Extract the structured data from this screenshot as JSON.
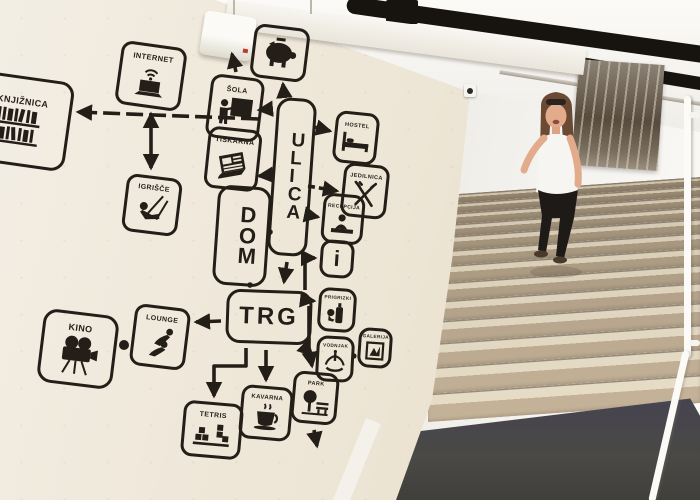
{
  "scene": {
    "setting": "hostel stairwell with black stencil mind-map mural painted on a cream wall; a woman walks down beige stone stairs; black pipes cross the white ceiling; a black-and-white forest photograph hangs on the upper wall; dark grey mat at the foot of the stairs; white handrail on the right wall",
    "colors": {
      "mural_wall": "#ece4d5",
      "stencil_ink": "#241e18",
      "back_wall": "#f4f2ee",
      "step_tread": "#ddd2bb",
      "step_riser": "#a69778",
      "floor_mat": "#4a4945",
      "pipes": "#17130f",
      "handrail": "#fcfbf8"
    },
    "objects": [
      "ceiling-pipes",
      "wall-beam",
      "light-fixture",
      "security-camera",
      "framed-forest-photo",
      "staircase",
      "floor-mat",
      "handrail",
      "woman-descending-stairs"
    ]
  },
  "mural": {
    "labels": {
      "knjiznica": "KNJIŽNICA",
      "internet": "INTERNET",
      "sola": "ŠOLA",
      "tiskarna": "TISKARNA",
      "ulica": "ULICA",
      "dom": "DOM",
      "igrisce": "IGRIŠČE",
      "hostel": "HOSTEL",
      "jedilnica": "JEDILNICA",
      "recepcija": "RECEPCIJA",
      "info": "i",
      "prigrizki": "PRIGRIZKI",
      "vodnjak": "VODNJAK",
      "galerija": "GALERIJA",
      "trg": "TRG",
      "kino": "KINO",
      "lounge": "LOUNGE",
      "tetris": "TETRIS",
      "kavarna": "KAVARNA",
      "park": "PARK"
    },
    "icons": [
      "bookshelf-icon",
      "laptop-wifi-icon",
      "piggy-bank-icon",
      "teacher-blackboard-icon",
      "newspaper-icon",
      "swing-icon",
      "bed-icon",
      "fork-knife-icon",
      "reception-desk-icon",
      "info-icon",
      "snack-drink-icon",
      "fountain-icon",
      "picture-frame-icon",
      "movie-camera-icon",
      "lounge-person-icon",
      "tetris-blocks-icon",
      "coffee-cup-icon",
      "tree-bench-icon"
    ]
  }
}
